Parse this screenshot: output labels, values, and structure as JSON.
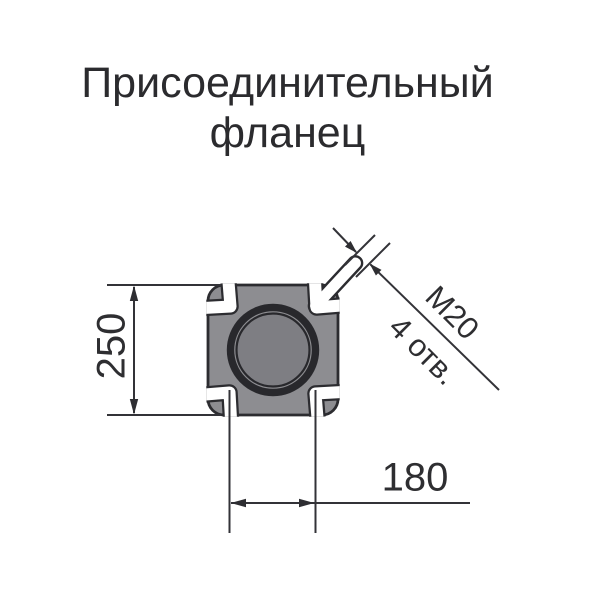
{
  "title": {
    "line1": "Присоединительный",
    "line2": "фланец"
  },
  "drawing": {
    "view": "flange top view",
    "flange": {
      "shape": "square with rounded corners, four open corner slots and central bore",
      "fill_color": "#8d8d91",
      "bore_fill_color": "#7e7e83",
      "outline_color": "#2c2c30",
      "line_color": "#333338"
    },
    "dimensions": {
      "height": "250",
      "spacing": "180",
      "thread": "М20",
      "holes": "4 отв."
    }
  }
}
